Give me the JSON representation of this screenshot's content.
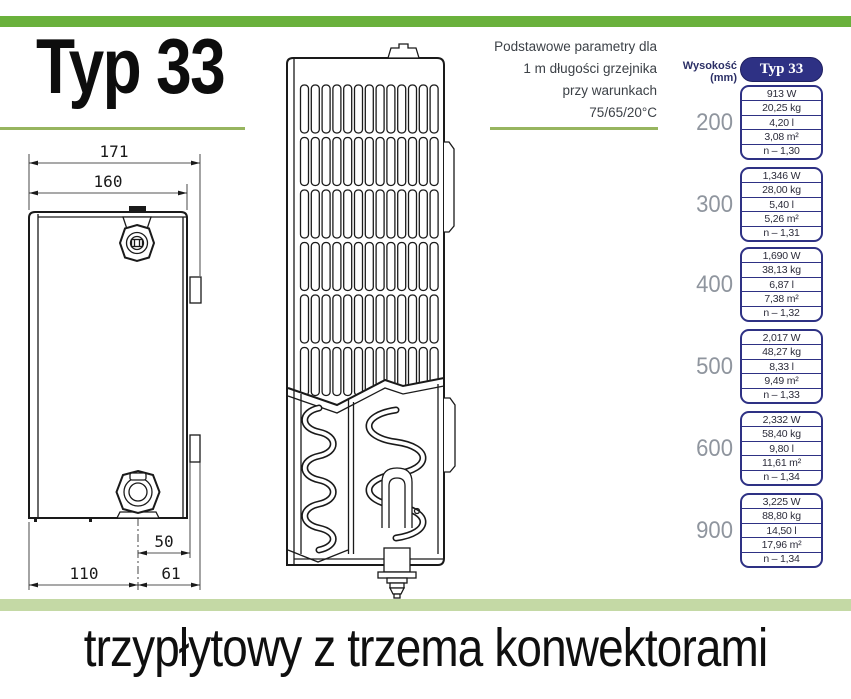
{
  "title": "Typ 33",
  "note": {
    "lines": [
      "Podstawowe parametry dla",
      "1 m długości grzejnika",
      "przy warunkach",
      "75/65/20°C"
    ]
  },
  "diagram": {
    "dims": {
      "total_width": "171",
      "core_width": "160",
      "offset_50": "50",
      "offset_110": "110",
      "offset_61": "61"
    }
  },
  "table": {
    "height_label": "Wysokość (mm)",
    "header": "Typ 33",
    "groups": [
      {
        "height": "200",
        "rows": [
          "913 W",
          "20,25 kg",
          "4,20 l",
          "3,08 m²",
          "n – 1,30"
        ]
      },
      {
        "height": "300",
        "rows": [
          "1,346 W",
          "28,00 kg",
          "5,40 l",
          "5,26 m²",
          "n – 1,31"
        ]
      },
      {
        "height": "400",
        "rows": [
          "1,690 W",
          "38,13 kg",
          "6,87 l",
          "7,38 m²",
          "n – 1,32"
        ]
      },
      {
        "height": "500",
        "rows": [
          "2,017 W",
          "48,27 kg",
          "8,33 l",
          "9,49 m²",
          "n – 1,33"
        ]
      },
      {
        "height": "600",
        "rows": [
          "2,332 W",
          "58,40 kg",
          "9,80 l",
          "11,61 m²",
          "n – 1,34"
        ]
      },
      {
        "height": "900",
        "rows": [
          "3,225 W",
          "88,80 kg",
          "14,50 l",
          "17,96 m²",
          "n – 1,34"
        ]
      }
    ]
  },
  "caption": "trzypłytowy z trzema konwektorami",
  "colors": {
    "accent_green": "#6ab13c",
    "underline_green": "#97b55f",
    "pale_green": "#c4d9a5",
    "navy": "#2e3184",
    "height_gray": "#8f959e",
    "line_art": "#1a1a1a"
  }
}
